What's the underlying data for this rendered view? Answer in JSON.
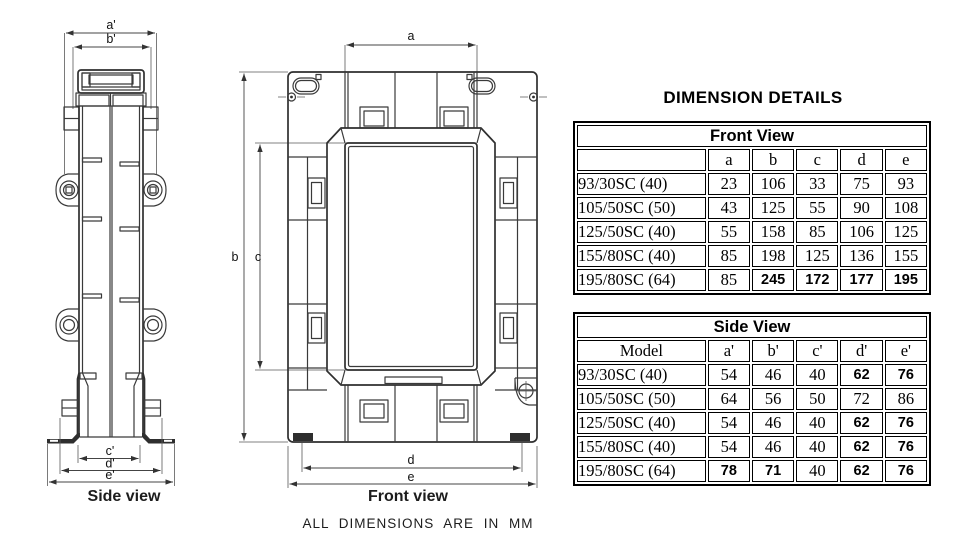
{
  "heading": "DIMENSION DETAILS",
  "units_note": "ALL DIMENSIONS ARE IN MM",
  "side_view": {
    "caption": "Side view",
    "dims": {
      "a": "a'",
      "b": "b'",
      "c": "c'",
      "d": "d'",
      "e": "e'"
    }
  },
  "front_view": {
    "caption": "Front view",
    "dims": {
      "a": "a",
      "b": "b",
      "c": "c",
      "d": "d",
      "e": "e"
    }
  },
  "tables": [
    {
      "title": "Front View",
      "header": [
        "",
        "a",
        "b",
        "c",
        "d",
        "e"
      ],
      "rows": [
        {
          "cells": [
            "93/30SC (40)",
            "23",
            "106",
            "33",
            "75",
            "93"
          ],
          "sans": [
            0,
            0,
            0,
            0,
            0,
            0
          ]
        },
        {
          "cells": [
            "105/50SC (50)",
            "43",
            "125",
            "55",
            "90",
            "108"
          ],
          "sans": [
            0,
            0,
            0,
            0,
            0,
            0
          ]
        },
        {
          "cells": [
            "125/50SC (40)",
            "55",
            "158",
            "85",
            "106",
            "125"
          ],
          "sans": [
            0,
            0,
            0,
            0,
            0,
            0
          ]
        },
        {
          "cells": [
            "155/80SC (40)",
            "85",
            "198",
            "125",
            "136",
            "155"
          ],
          "sans": [
            0,
            0,
            0,
            0,
            0,
            0
          ]
        },
        {
          "cells": [
            "195/80SC (64)",
            "85",
            "245",
            "172",
            "177",
            "195"
          ],
          "sans": [
            0,
            0,
            1,
            1,
            1,
            1
          ]
        }
      ]
    },
    {
      "title": "Side View",
      "header": [
        "Model",
        "a'",
        "b'",
        "c'",
        "d'",
        "e'"
      ],
      "rows": [
        {
          "cells": [
            "93/30SC (40)",
            "54",
            "46",
            "40",
            "62",
            "76"
          ],
          "sans": [
            0,
            0,
            0,
            0,
            1,
            1
          ]
        },
        {
          "cells": [
            "105/50SC (50)",
            "64",
            "56",
            "50",
            "72",
            "86"
          ],
          "sans": [
            0,
            0,
            0,
            0,
            0,
            0
          ]
        },
        {
          "cells": [
            "125/50SC (40)",
            "54",
            "46",
            "40",
            "62",
            "76"
          ],
          "sans": [
            0,
            0,
            0,
            0,
            1,
            1
          ]
        },
        {
          "cells": [
            "155/80SC (40)",
            "54",
            "46",
            "40",
            "62",
            "76"
          ],
          "sans": [
            0,
            0,
            0,
            0,
            1,
            1
          ]
        },
        {
          "cells": [
            "195/80SC (64)",
            "78",
            "71",
            "40",
            "62",
            "76"
          ],
          "sans": [
            0,
            1,
            1,
            0,
            1,
            1
          ]
        }
      ]
    }
  ],
  "colors": {
    "line": "#3a3a3a",
    "text": "#000000",
    "background": "#ffffff"
  }
}
